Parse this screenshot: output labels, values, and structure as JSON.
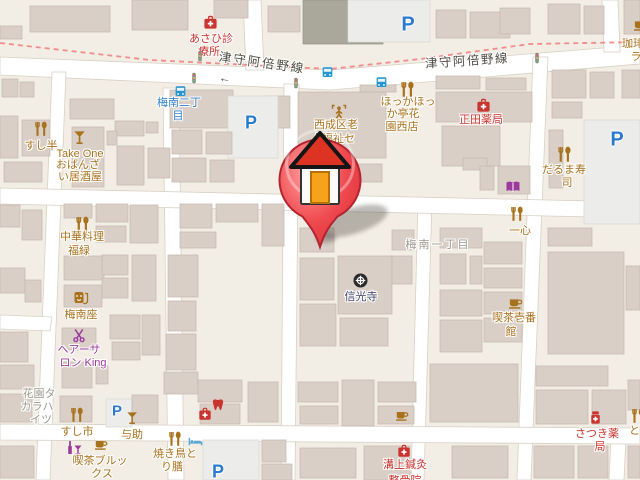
{
  "map": {
    "colors": {
      "background": "#f3eee5",
      "building": "#d9cfc7",
      "building_stroke": "#c6b9ae",
      "road": "#ffffff",
      "boundary_dash": "#ef8181",
      "poi_brown": "#a8721d",
      "poi_red": "#c9342e",
      "poi_purple": "#9c3a9c",
      "poi_blue": "#2596d1",
      "label_gray": "#9d988f",
      "temple_navy": "#40406b",
      "road_label": "#4f4b44",
      "parking_blue": "#2b7ad0"
    },
    "pin": {
      "x": 320,
      "y": 245,
      "kind": "house-marker"
    },
    "pois": [
      {
        "id": "poi-asahi-clinic",
        "color": "#c9342e",
        "icons": [
          {
            "type": "firstaid",
            "x": 210,
            "y": 22,
            "s": 15
          }
        ],
        "lines": [
          {
            "t": "あさひ診",
            "x": 211,
            "y": 33
          },
          {
            "t": "療所",
            "x": 209,
            "y": 46
          }
        ]
      },
      {
        "id": "parking-top",
        "icons": [
          {
            "type": "parking",
            "x": 408,
            "y": 25,
            "s": 20,
            "text": "P"
          }
        ]
      },
      {
        "id": "bus-stop-umeminami2",
        "color": "#2f7ec7",
        "icons": [
          {
            "type": "bus",
            "x": 180,
            "y": 91,
            "s": 13
          }
        ],
        "lines": [
          {
            "t": "梅南二丁",
            "x": 179,
            "y": 97
          },
          {
            "t": "目",
            "x": 178,
            "y": 110
          }
        ]
      },
      {
        "id": "bus-stop-east-1",
        "icons": [
          {
            "type": "bus",
            "x": 327,
            "y": 72,
            "s": 13
          }
        ]
      },
      {
        "id": "bus-stop-east-2",
        "icons": [
          {
            "type": "bus",
            "x": 381,
            "y": 82,
            "s": 13
          }
        ]
      },
      {
        "id": "traffic-signal-1",
        "icons": [
          {
            "type": "signal",
            "x": 200,
            "y": 55,
            "s": 12
          }
        ]
      },
      {
        "id": "traffic-signal-2",
        "icons": [
          {
            "type": "signal",
            "x": 194,
            "y": 77,
            "s": 12
          }
        ]
      },
      {
        "id": "traffic-signal-3",
        "icons": [
          {
            "type": "signal",
            "x": 296,
            "y": 82,
            "s": 12
          }
        ]
      },
      {
        "id": "traffic-signal-4",
        "icons": [
          {
            "type": "signal",
            "x": 537,
            "y": 57,
            "s": 12
          }
        ]
      },
      {
        "id": "road-label-west",
        "color": "#4f4b44",
        "ia": false,
        "lines": [
          {
            "t": "津守阿倍野線",
            "x": 262,
            "y": 57,
            "rot": 8,
            "sp": 2,
            "fs": 12.5
          },
          {
            "t": "←",
            "x": 225,
            "y": 72,
            "rot": 8,
            "fs": 12
          }
        ]
      },
      {
        "id": "road-label-east",
        "color": "#4f4b44",
        "ia": false,
        "lines": [
          {
            "t": "津守阿倍野線",
            "x": 467,
            "y": 55,
            "rot": -4,
            "sp": 1.5,
            "fs": 12.5
          }
        ]
      },
      {
        "id": "poi-hokkahokka-tei",
        "color": "#a8721d",
        "icons": [
          {
            "type": "restaurant",
            "x": 407,
            "y": 89,
            "s": 17
          }
        ],
        "lines": [
          {
            "t": "ほっかほっ",
            "x": 408,
            "y": 96
          },
          {
            "t": "か亭花",
            "x": 403,
            "y": 108
          },
          {
            "t": "園西店",
            "x": 402,
            "y": 121
          }
        ]
      },
      {
        "id": "poi-shoda-pharmacy",
        "color": "#c9342e",
        "icons": [
          {
            "type": "firstaid",
            "x": 483,
            "y": 105,
            "s": 15
          }
        ],
        "lines": [
          {
            "t": "正田薬局",
            "x": 481,
            "y": 114
          }
        ]
      },
      {
        "id": "poi-welfare-center",
        "color": "#a8721d",
        "icons": [
          {
            "type": "welfare",
            "x": 339,
            "y": 112,
            "s": 16
          }
        ],
        "lines": [
          {
            "t": "西成区老",
            "x": 336,
            "y": 119
          },
          {
            "t": "人福祉セ",
            "x": 333,
            "y": 133
          }
        ]
      },
      {
        "id": "poi-tore",
        "color": "#a8721d",
        "lines": [
          {
            "t": "トレ",
            "x": 292,
            "y": 186
          }
        ]
      },
      {
        "id": "poi-daruma-sushi",
        "color": "#a8721d",
        "icons": [
          {
            "type": "restaurant",
            "x": 564,
            "y": 154,
            "s": 17
          }
        ],
        "lines": [
          {
            "t": "だるま寿",
            "x": 564,
            "y": 164
          },
          {
            "t": "司",
            "x": 567,
            "y": 177
          }
        ]
      },
      {
        "id": "poi-bookstore",
        "color": "#9c3a9c",
        "icons": [
          {
            "type": "book",
            "x": 513,
            "y": 187,
            "s": 16
          }
        ]
      },
      {
        "id": "poi-isshin",
        "color": "#a8721d",
        "icons": [
          {
            "type": "restaurant",
            "x": 517,
            "y": 214,
            "s": 16
          }
        ],
        "lines": [
          {
            "t": "一心",
            "x": 520,
            "y": 225
          }
        ]
      },
      {
        "id": "poi-kissa-ichibankan",
        "color": "#a8721d",
        "icons": [
          {
            "type": "cafe",
            "x": 515,
            "y": 302,
            "s": 15
          }
        ],
        "lines": [
          {
            "t": "喫茶壱番",
            "x": 514,
            "y": 312
          },
          {
            "t": "館",
            "x": 511,
            "y": 326
          }
        ]
      },
      {
        "id": "district-umeminami-1chome",
        "color": "#9d988f",
        "ia": false,
        "lines": [
          {
            "t": "梅南一丁目",
            "x": 438,
            "y": 239,
            "sp": 2
          }
        ]
      },
      {
        "id": "poi-shinkoji-temple",
        "color": "#40406b",
        "icons": [
          {
            "type": "temple",
            "x": 360,
            "y": 280,
            "s": 17
          }
        ],
        "lines": [
          {
            "t": "信光寺",
            "x": 361,
            "y": 291
          }
        ]
      },
      {
        "id": "poi-chuka-fukumidori",
        "color": "#a8721d",
        "icons": [
          {
            "type": "restaurant",
            "x": 82,
            "y": 224,
            "s": 17
          }
        ],
        "lines": [
          {
            "t": "中華料理",
            "x": 82,
            "y": 231
          },
          {
            "t": "福緑",
            "x": 79,
            "y": 245
          }
        ]
      },
      {
        "id": "poi-umeminamiza",
        "color": "#a8721d",
        "icons": [
          {
            "type": "theater",
            "x": 81,
            "y": 298,
            "s": 16
          }
        ],
        "lines": [
          {
            "t": "梅南座",
            "x": 81,
            "y": 309
          }
        ]
      },
      {
        "id": "poi-hair-salon-king",
        "color": "#9c3a9c",
        "icons": [
          {
            "type": "scissors",
            "x": 79,
            "y": 335,
            "s": 15
          }
        ],
        "lines": [
          {
            "t": "ヘアーサ",
            "x": 79,
            "y": 344
          },
          {
            "t": "ロン King",
            "x": 83,
            "y": 357
          }
        ]
      },
      {
        "id": "label-hanazono-takara-heights",
        "color": "#9d988f",
        "ia": false,
        "lines": [
          {
            "t": "花園タ",
            "x": 39,
            "y": 388
          },
          {
            "t": "カラハ",
            "x": 37,
            "y": 401
          },
          {
            "t": "イツ",
            "x": 41,
            "y": 414
          }
        ]
      },
      {
        "id": "poi-sushi-han",
        "color": "#a8721d",
        "icons": [
          {
            "type": "restaurant",
            "x": 41,
            "y": 129,
            "s": 16
          }
        ],
        "lines": [
          {
            "t": "すし半",
            "x": 41,
            "y": 140
          }
        ]
      },
      {
        "id": "poi-take-one",
        "color": "#a8721d",
        "icons": [
          {
            "type": "cocktail",
            "x": 80,
            "y": 137,
            "s": 15
          }
        ],
        "lines": [
          {
            "t": "Take One",
            "x": 80,
            "y": 148
          },
          {
            "t": "おばんざ",
            "x": 78,
            "y": 159
          },
          {
            "t": "い居酒屋",
            "x": 80,
            "y": 171
          }
        ]
      },
      {
        "id": "poi-sushi-ichi",
        "color": "#a8721d",
        "icons": [
          {
            "type": "restaurant",
            "x": 77,
            "y": 415,
            "s": 16
          }
        ],
        "lines": [
          {
            "t": "すし市",
            "x": 77,
            "y": 426
          }
        ]
      },
      {
        "id": "parking-yosuke",
        "icons": [
          {
            "type": "parking",
            "x": 117,
            "y": 411,
            "s": 15,
            "text": "P"
          }
        ]
      },
      {
        "id": "poi-yosuke",
        "color": "#a8721d",
        "icons": [
          {
            "type": "cocktail",
            "x": 133,
            "y": 418,
            "s": 14
          }
        ],
        "lines": [
          {
            "t": "与助",
            "x": 132,
            "y": 429
          }
        ]
      },
      {
        "id": "poi-kissa-brooks",
        "color": "#a8721d",
        "icons": [
          {
            "type": "bar",
            "x": 74,
            "y": 448,
            "s": 16,
            "color": "#9c3a9c"
          },
          {
            "type": "cafe",
            "x": 101,
            "y": 444,
            "s": 14
          }
        ],
        "lines": [
          {
            "t": "喫茶ブルッ",
            "x": 100,
            "y": 455
          },
          {
            "t": "クス",
            "x": 102,
            "y": 468
          }
        ]
      },
      {
        "id": "poi-yakitori-torizen",
        "color": "#a8721d",
        "icons": [
          {
            "type": "restaurant",
            "x": 175,
            "y": 439,
            "s": 16
          },
          {
            "type": "bed",
            "x": 195,
            "y": 441,
            "s": 15,
            "color": "#5aa7d6"
          }
        ],
        "lines": [
          {
            "t": "焼き鳥と",
            "x": 175,
            "y": 448
          },
          {
            "t": "り膳",
            "x": 172,
            "y": 461
          }
        ]
      },
      {
        "id": "poi-dental-clinic",
        "color": "#c9342e",
        "icons": [
          {
            "type": "firstaid",
            "x": 205,
            "y": 414,
            "s": 14
          },
          {
            "type": "tooth",
            "x": 218,
            "y": 405,
            "s": 14
          }
        ]
      },
      {
        "id": "poi-cafe-center",
        "color": "#a8721d",
        "icons": [
          {
            "type": "cafe",
            "x": 402,
            "y": 415,
            "s": 14
          }
        ]
      },
      {
        "id": "poi-mizokami-shinkyu",
        "color": "#c9342e",
        "icons": [
          {
            "type": "firstaid",
            "x": 404,
            "y": 451,
            "s": 14
          }
        ],
        "lines": [
          {
            "t": "溝上鍼灸",
            "x": 405,
            "y": 459
          },
          {
            "t": "整骨院",
            "x": 405,
            "y": 475
          }
        ]
      },
      {
        "id": "poi-satsuki-pharmacy",
        "color": "#c9342e",
        "icons": [
          {
            "type": "medicine",
            "x": 595,
            "y": 417,
            "s": 15
          }
        ],
        "lines": [
          {
            "t": "さつき薬",
            "x": 597,
            "y": 428
          },
          {
            "t": "局",
            "x": 600,
            "y": 441
          }
        ]
      },
      {
        "id": "poi-tori-edge",
        "color": "#a8721d",
        "icons": [
          {
            "type": "restaurant",
            "x": 638,
            "y": 416,
            "s": 16
          }
        ],
        "lines": [
          {
            "t": "とり",
            "x": 640,
            "y": 425
          }
        ]
      },
      {
        "id": "poi-coffee-topright",
        "color": "#a8721d",
        "icons": [
          {
            "type": "cafe",
            "x": 640,
            "y": 24,
            "s": 15
          }
        ],
        "lines": [
          {
            "t": "珈琲",
            "x": 633,
            "y": 38
          },
          {
            "t": "ラ",
            "x": 636,
            "y": 51
          }
        ]
      },
      {
        "id": "parking-left",
        "icons": [
          {
            "type": "parking",
            "x": 251,
            "y": 123,
            "s": 18,
            "text": "P"
          }
        ]
      },
      {
        "id": "parking-right",
        "icons": [
          {
            "type": "parking",
            "x": 617,
            "y": 140,
            "s": 20,
            "text": "P"
          }
        ]
      },
      {
        "id": "parking-bottom",
        "icons": [
          {
            "type": "parking",
            "x": 218,
            "y": 472,
            "s": 18,
            "text": "P"
          }
        ]
      }
    ]
  }
}
